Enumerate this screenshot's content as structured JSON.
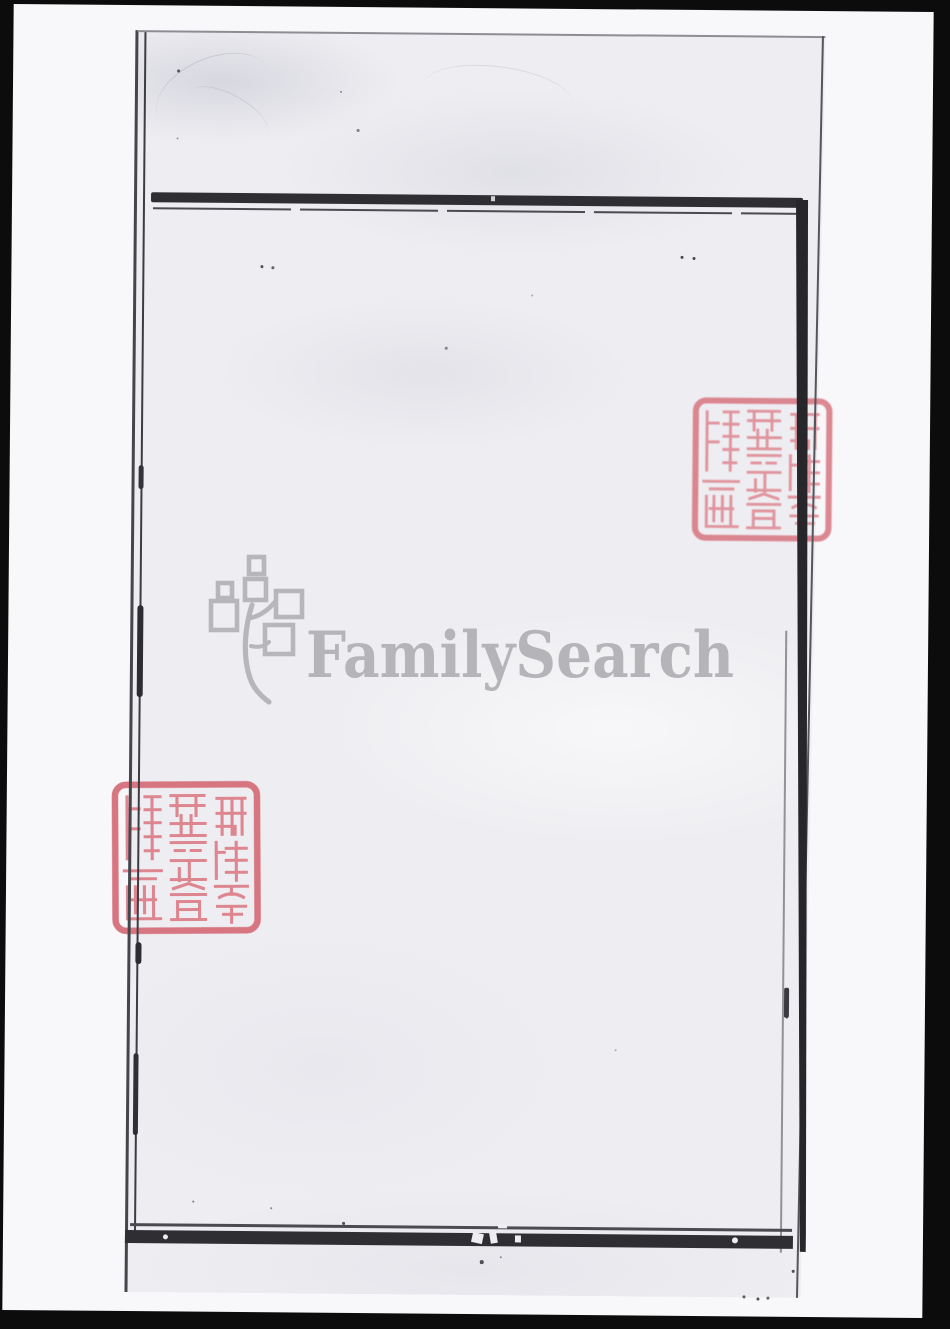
{
  "photo": {
    "background": "black camera margin",
    "paper_tone": "#f8f8fa",
    "scanned_page_tone": "#eeeef2",
    "frame_ink_color": "#2e2e33",
    "page_text": ""
  },
  "watermark": {
    "brand": "FamilySearch",
    "color": "#b7b7bb",
    "logo_icon": "family-tree-squares-icon"
  },
  "seals": {
    "characters": "猶他家譜學會攝藏",
    "color": "#d9767f",
    "count": 2,
    "instances": [
      {
        "position": "upper-right, overlapped by the printed border bar"
      },
      {
        "position": "middle-left, overlapped by the page edge lines"
      }
    ]
  },
  "colors": {
    "background": "#0c0c0c",
    "photo_paper": "#f8f8fa",
    "scanned_page": "#eeeef2",
    "frame_ink": "#2e2e33",
    "seal_red": "#d9767f",
    "watermark_gray": "#b7b7bb"
  }
}
